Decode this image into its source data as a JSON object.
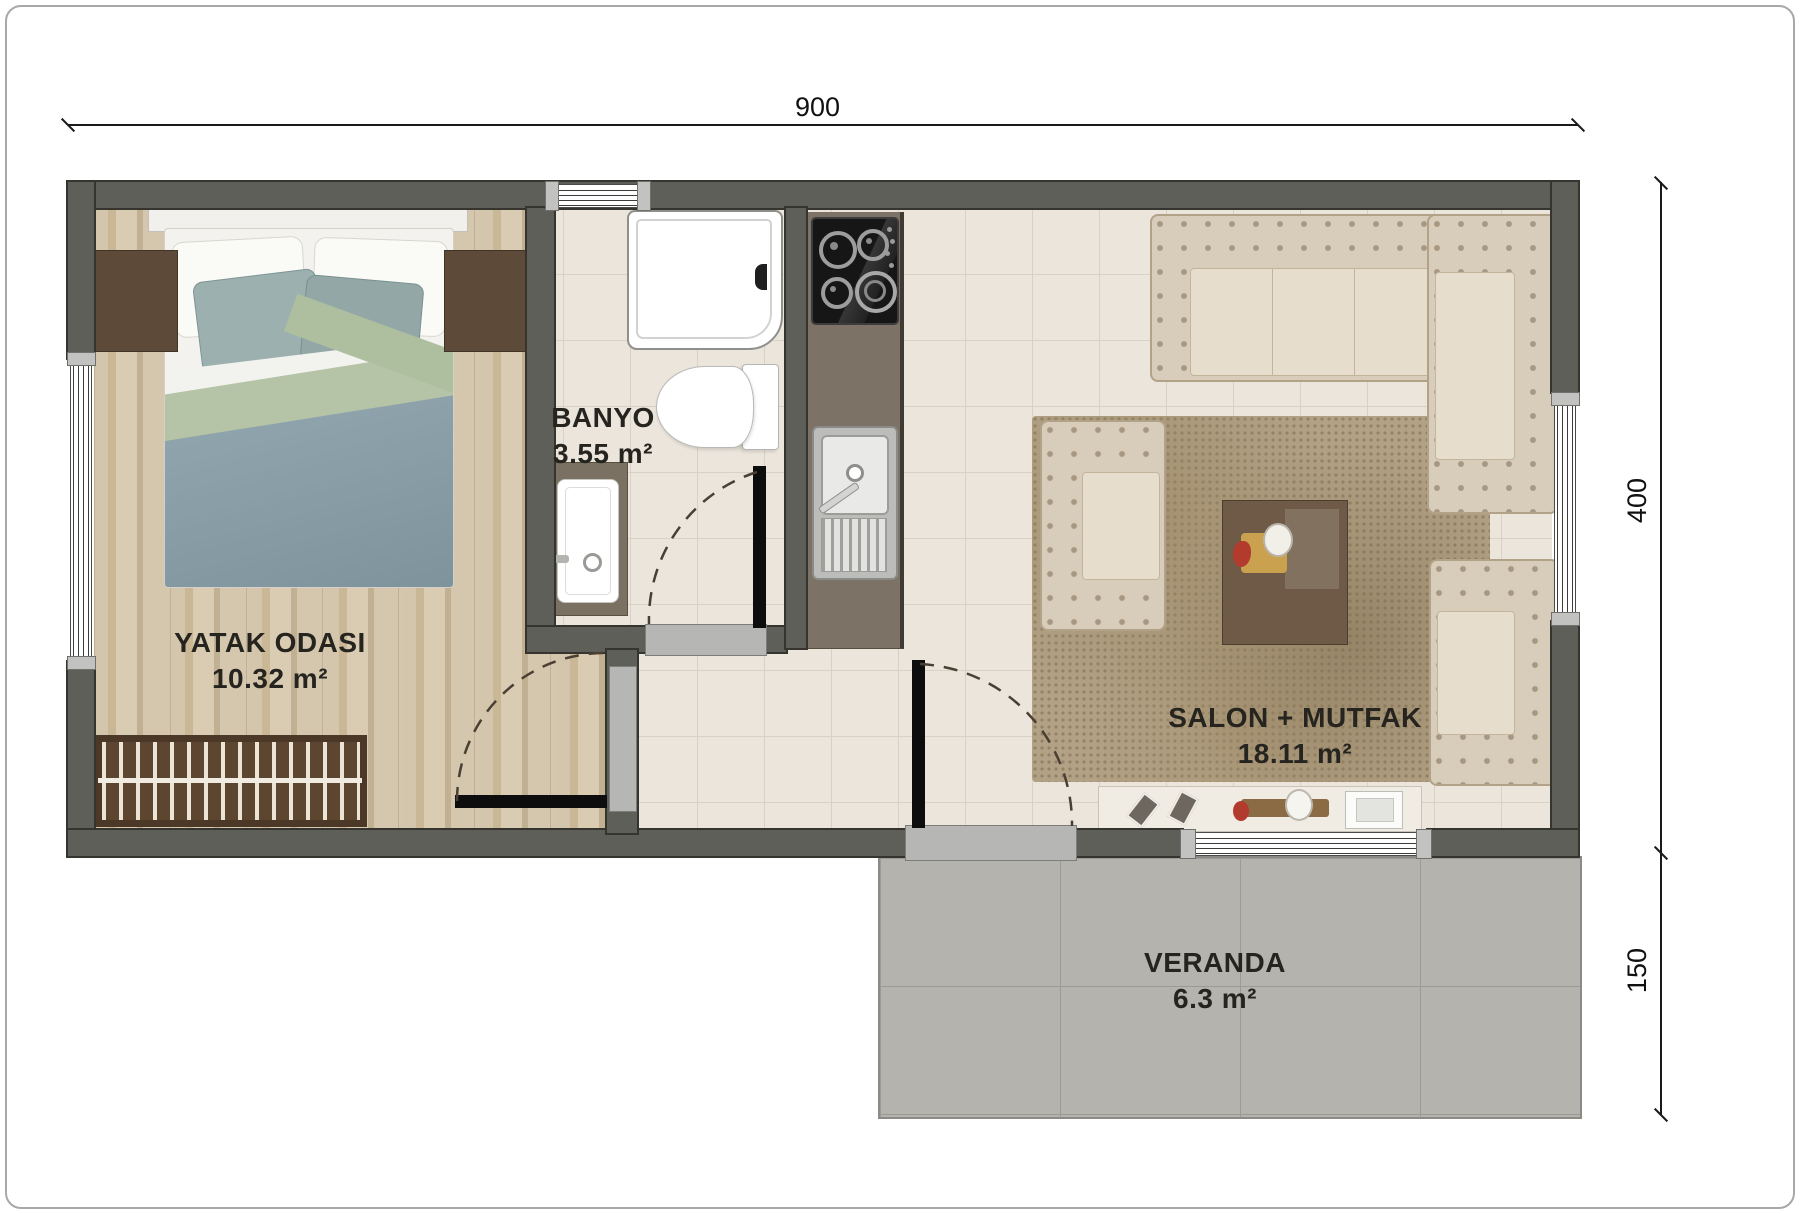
{
  "title": "Apartment floor plan",
  "dimensions": {
    "width_total": "900",
    "height_main": "400",
    "height_veranda": "150"
  },
  "rooms": {
    "bedroom": {
      "name": "YATAK ODASI",
      "area": "10.32 m²"
    },
    "bathroom": {
      "name": "BANYO",
      "area": "3.55 m²"
    },
    "living": {
      "name": "SALON + MUTFAK",
      "area": "18.11 m²"
    },
    "veranda": {
      "name": "VERANDA",
      "area": "6.3 m²"
    }
  },
  "furniture": [
    "double-bed",
    "nightstand-left",
    "nightstand-right",
    "bench-radiator",
    "shower",
    "toilet",
    "bathroom-sink",
    "stove-hob",
    "kitchen-counter",
    "kitchen-sink",
    "corner-sofa",
    "armchair-left",
    "armchair-right",
    "rug",
    "coffee-table",
    "tv-console",
    "tv"
  ],
  "colors": {
    "wall": "#5f5f59",
    "wood_floor": "#d0c2a8",
    "tile_floor": "#ebe5dc",
    "veranda_floor": "#b5b3ae",
    "sofa": "#d8ccba",
    "duvet": "#8ba0aa",
    "accent_sage": "#b5c3a6"
  }
}
